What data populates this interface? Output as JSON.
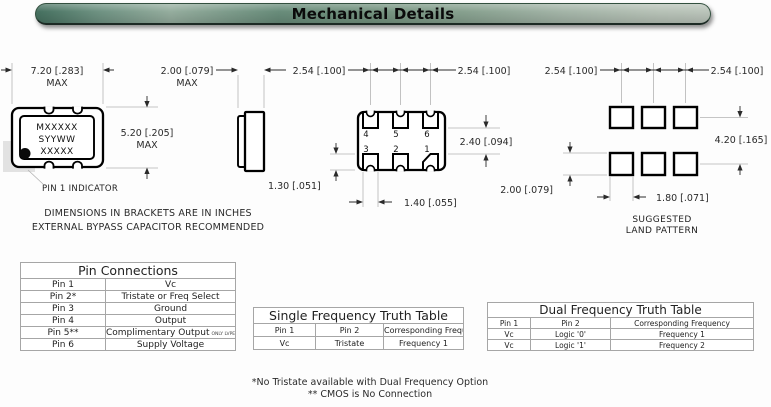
{
  "banner": {
    "title": "Mechanical Details"
  },
  "colors": {
    "banner_left": "#45705f",
    "banner_right": "#bac4ba",
    "drawing_line": "#000000",
    "dim_line": "#2a2a2a",
    "ext_line": "#b3b3b3",
    "table_border": "#a6a6a6",
    "pin1_shade": "#e2e2e2"
  },
  "front_view": {
    "marking": [
      "MXXXXX",
      "SYYWW",
      "XXXXX"
    ],
    "pin1_label": "PIN 1 INDICATOR",
    "dim_width": "7.20 [.283]",
    "dim_width_qualifier": "MAX",
    "dim_height": "5.20 [.205]",
    "dim_height_qualifier": "MAX"
  },
  "side_view": {
    "dim_thickness": "2.00 [.079]",
    "dim_thickness_qualifier": "MAX",
    "dim_pad": "1.30 [.051]"
  },
  "bottom_view": {
    "pins_top": [
      "4",
      "5",
      "6"
    ],
    "pins_bottom": [
      "3",
      "2",
      "1"
    ],
    "dim_pitch_left": "2.54 [.100]",
    "dim_pitch_right": "2.54 [.100]",
    "dim_pad_gap": "2.40 [.094]",
    "dim_pad_width": "1.40 [.055]",
    "dim_row_offset": "2.00 [.079]"
  },
  "land_pattern": {
    "dim_pitch_left": "2.54 [.100]",
    "dim_pitch_right": "2.54 [.100]",
    "dim_row_span": "4.20 [.165]",
    "dim_pad_width": "1.80 [.071]",
    "caption": [
      "SUGGESTED",
      "LAND PATTERN"
    ]
  },
  "notes": [
    "DIMENSIONS IN BRACKETS ARE IN INCHES",
    "EXTERNAL BYPASS CAPACITOR RECOMMENDED"
  ],
  "pin_table": {
    "title": "Pin Connections",
    "rows": [
      {
        "pin": "Pin 1",
        "function": "Vc",
        "note": ""
      },
      {
        "pin": "Pin 2*",
        "function": "Tristate or Freq Select",
        "note": ""
      },
      {
        "pin": "Pin 3",
        "function": "Ground",
        "note": ""
      },
      {
        "pin": "Pin 4",
        "function": "Output",
        "note": ""
      },
      {
        "pin": "Pin 5**",
        "function": "Complimentary Output",
        "note": "ONLY LVPECL & LVDS"
      },
      {
        "pin": "Pin 6",
        "function": "Supply Voltage",
        "note": ""
      }
    ]
  },
  "single_freq_table": {
    "title": "Single Frequency Truth Table",
    "headers": [
      "Pin 1",
      "Pin 2",
      "Corresponding Frequency"
    ],
    "rows": [
      [
        "Vc",
        "Tristate",
        "Frequency 1"
      ]
    ]
  },
  "dual_freq_table": {
    "title": "Dual Frequency Truth Table",
    "headers": [
      "Pin 1",
      "Pin 2",
      "Corresponding Frequency"
    ],
    "rows": [
      [
        "Vc",
        "Logic '0'",
        "Frequency 1"
      ],
      [
        "Vc",
        "Logic '1'",
        "Frequency 2"
      ]
    ]
  },
  "footnotes": [
    "*No Tristate available with Dual Frequency Option",
    "** CMOS is No Connection"
  ]
}
